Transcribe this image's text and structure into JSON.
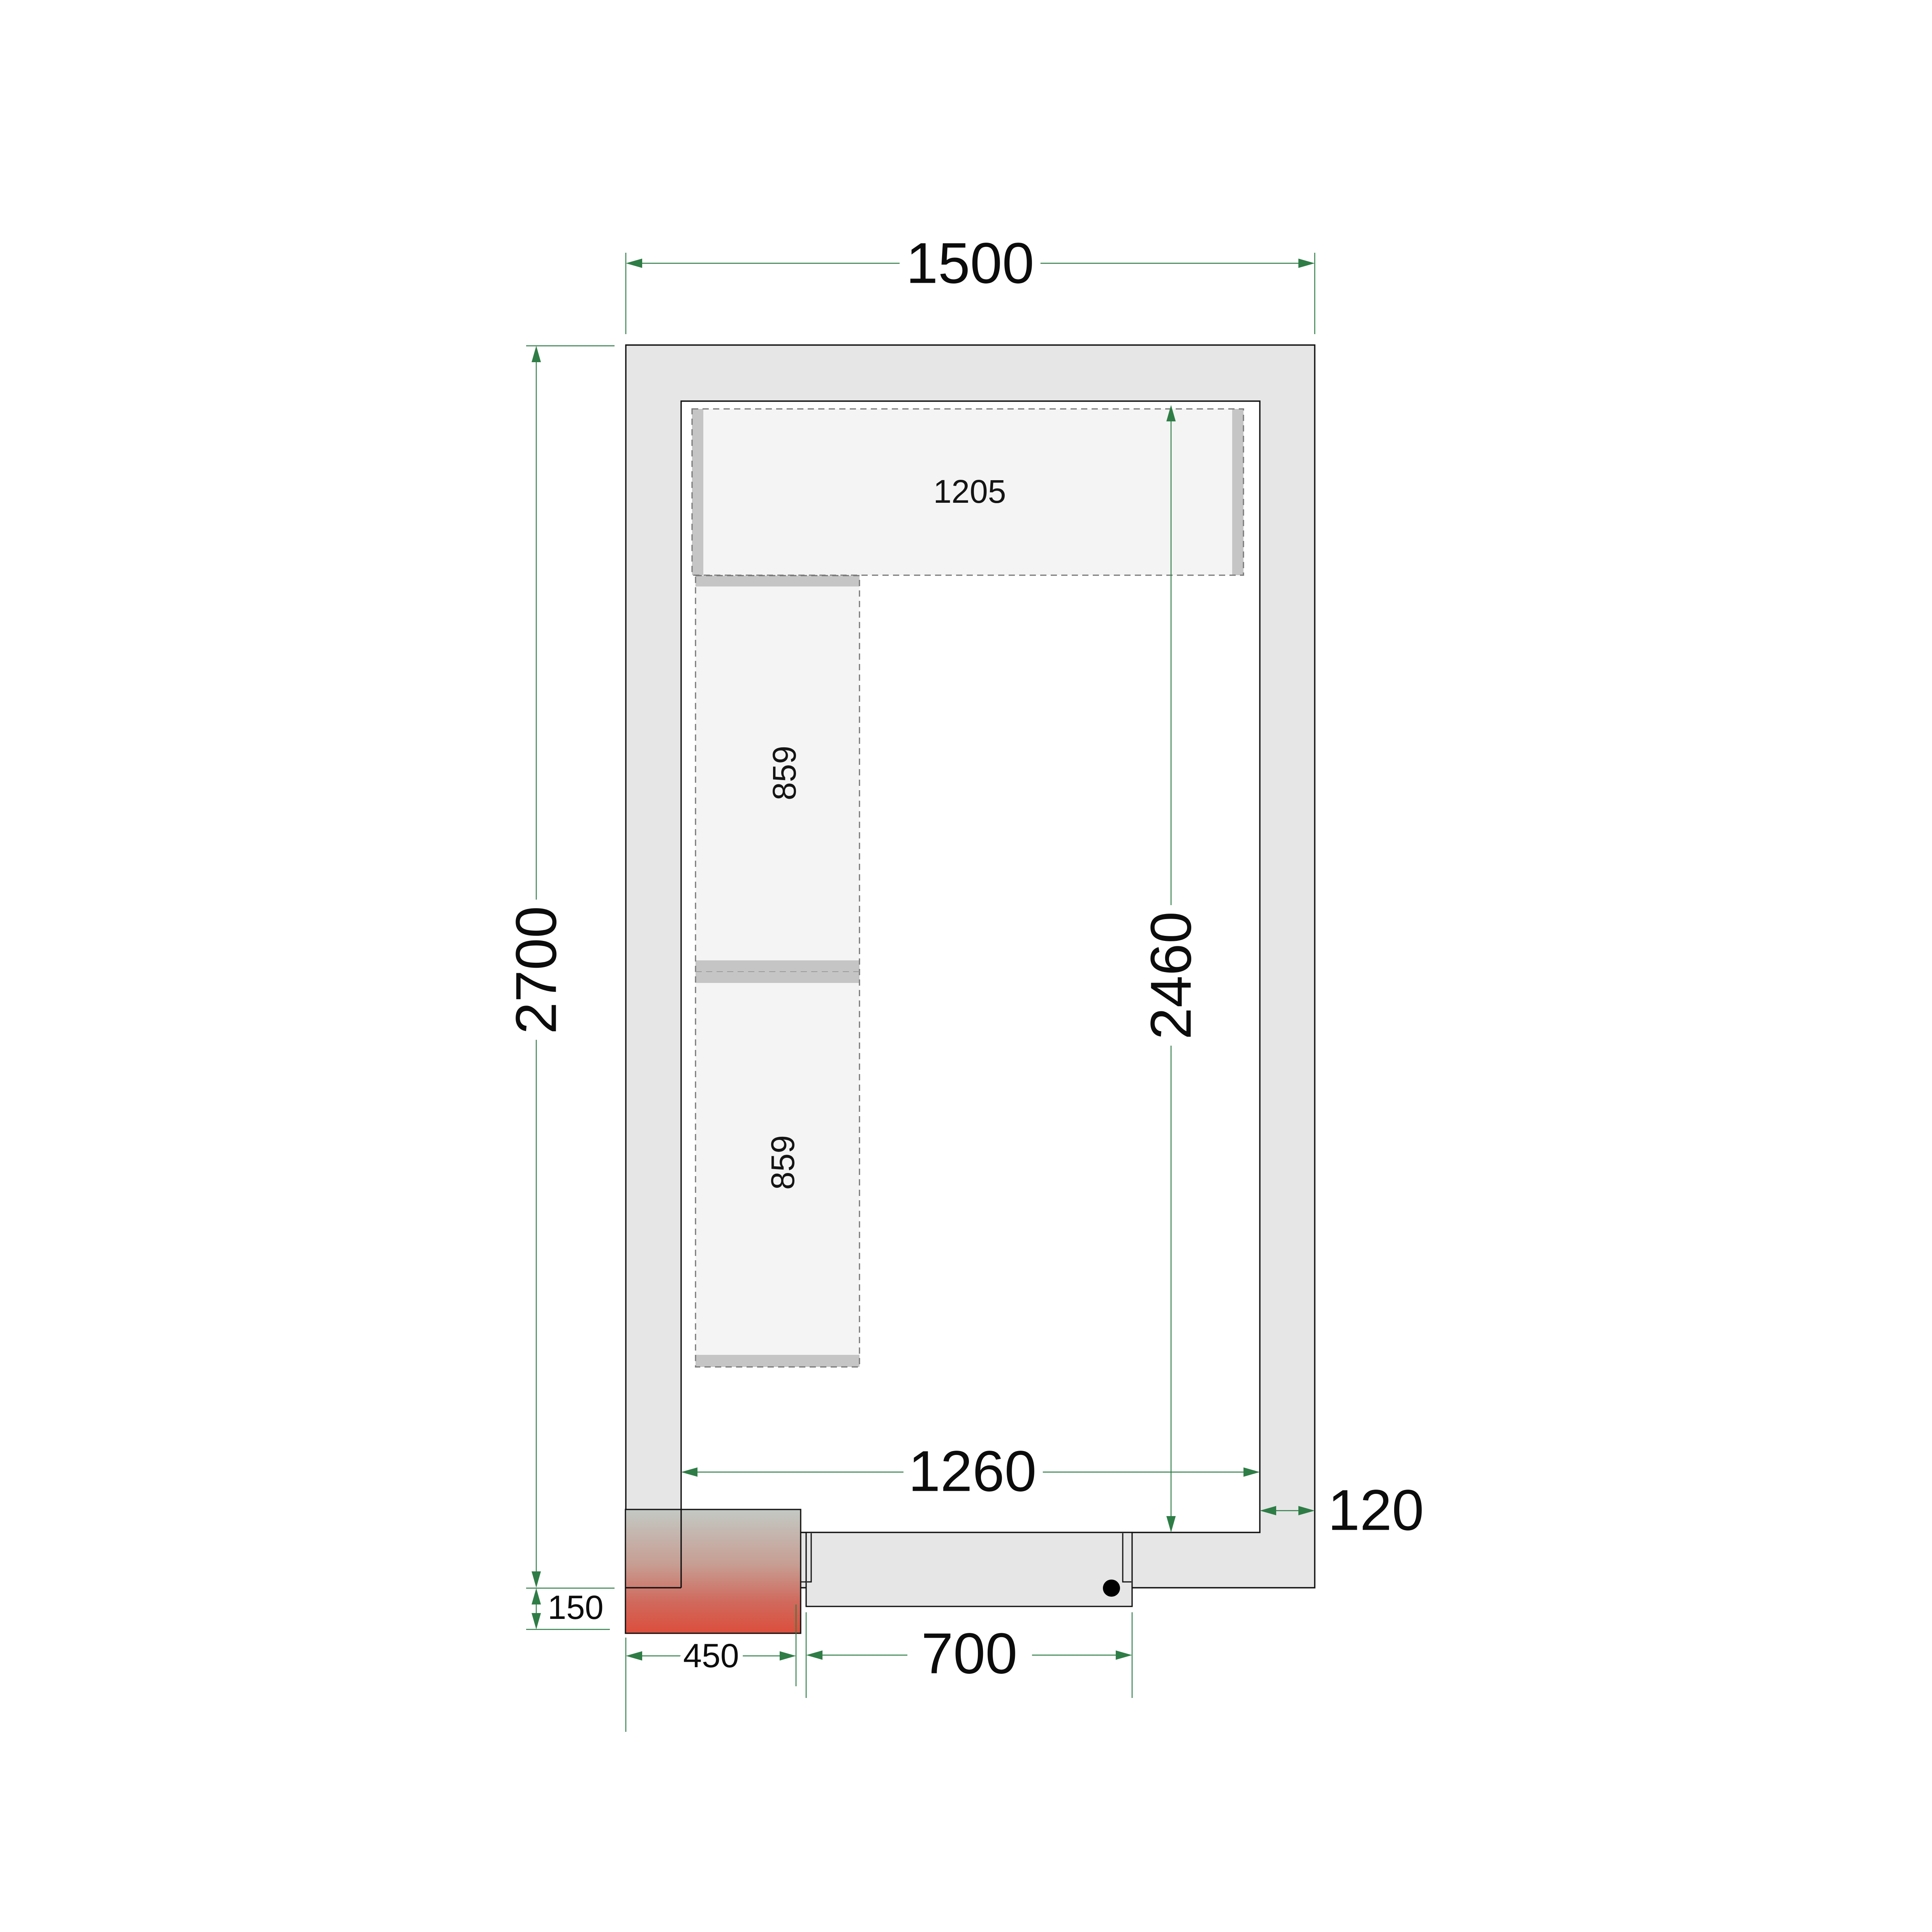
{
  "drawing": {
    "title": "cold-room-floor-plan",
    "labels": {
      "outer_width": "1500",
      "outer_depth": "2700",
      "inner_depth": "2460",
      "inner_width": "1260",
      "wall_thickness": "120",
      "door_opening_width": "700",
      "unit_width": "450",
      "unit_overhang": "150",
      "shelf_top_length": "1205",
      "shelf_left_upper_length": "859",
      "shelf_left_lower_length": "859"
    },
    "colors": {
      "dimension_green": "#2e7d46",
      "wall_fill": "#e6e6e6",
      "outline_black": "#111111",
      "shelf_fill": "#f4f4f4",
      "shelf_bar_gray": "#c5c5c5",
      "shelf_dash_gray": "#767676",
      "heater_gradient_top": "#c3c9c4",
      "heater_gradient_mid": "#cc8478",
      "heater_gradient_bottom": "#dc4e3c",
      "background": "#ffffff"
    }
  }
}
